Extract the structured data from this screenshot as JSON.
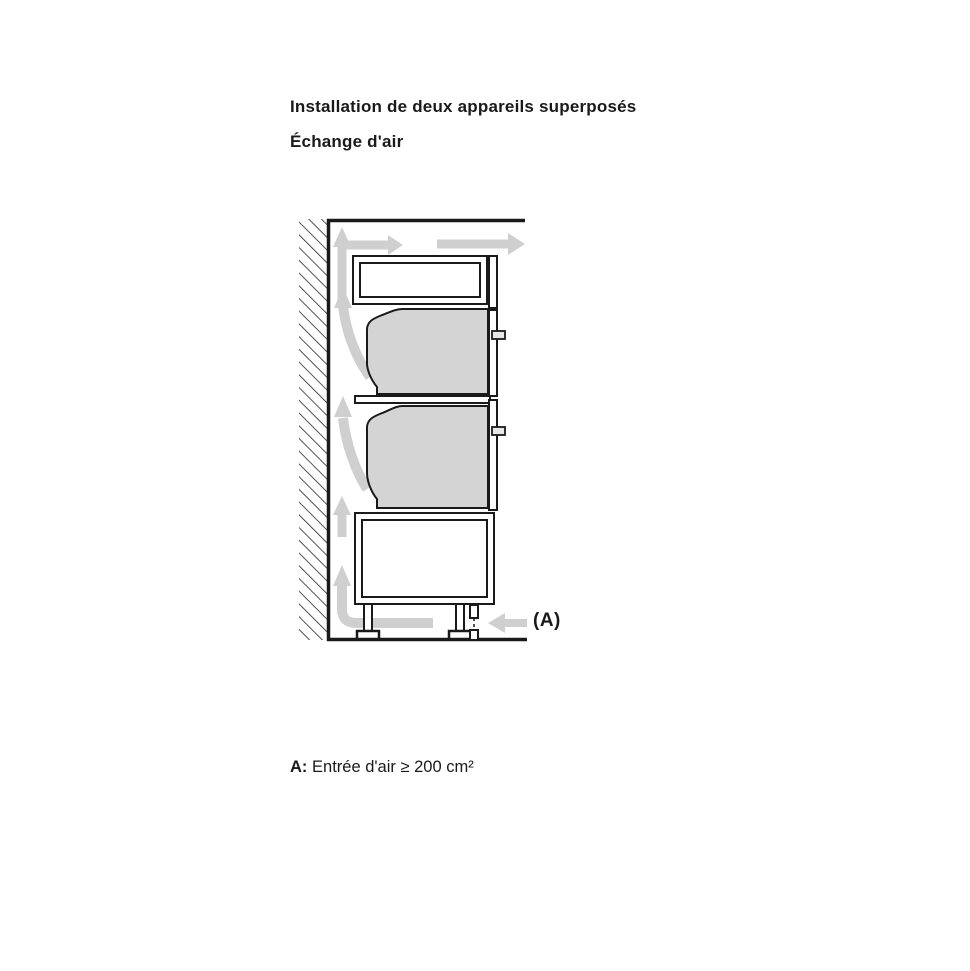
{
  "page": {
    "title": "Installation de deux appareils superposés",
    "subtitle": "Échange d'air"
  },
  "diagram": {
    "label_a": "(A)",
    "description": "Side cutaway of tall cabinet against a hatched wall with two stacked built-in ovens, top vent compartment, base cabinet on legs, and gray airflow arrows rising in the rear wall gap, exiting at top and entering at bottom inlet A"
  },
  "legend": {
    "term": "A:",
    "description": "Entrée d'air ≥ 200 cm²"
  },
  "colors": {
    "line": "#1a1a1a",
    "arrow": "#cfcfcf",
    "appliance_fill": "#d4d4d4",
    "background": "#ffffff"
  }
}
